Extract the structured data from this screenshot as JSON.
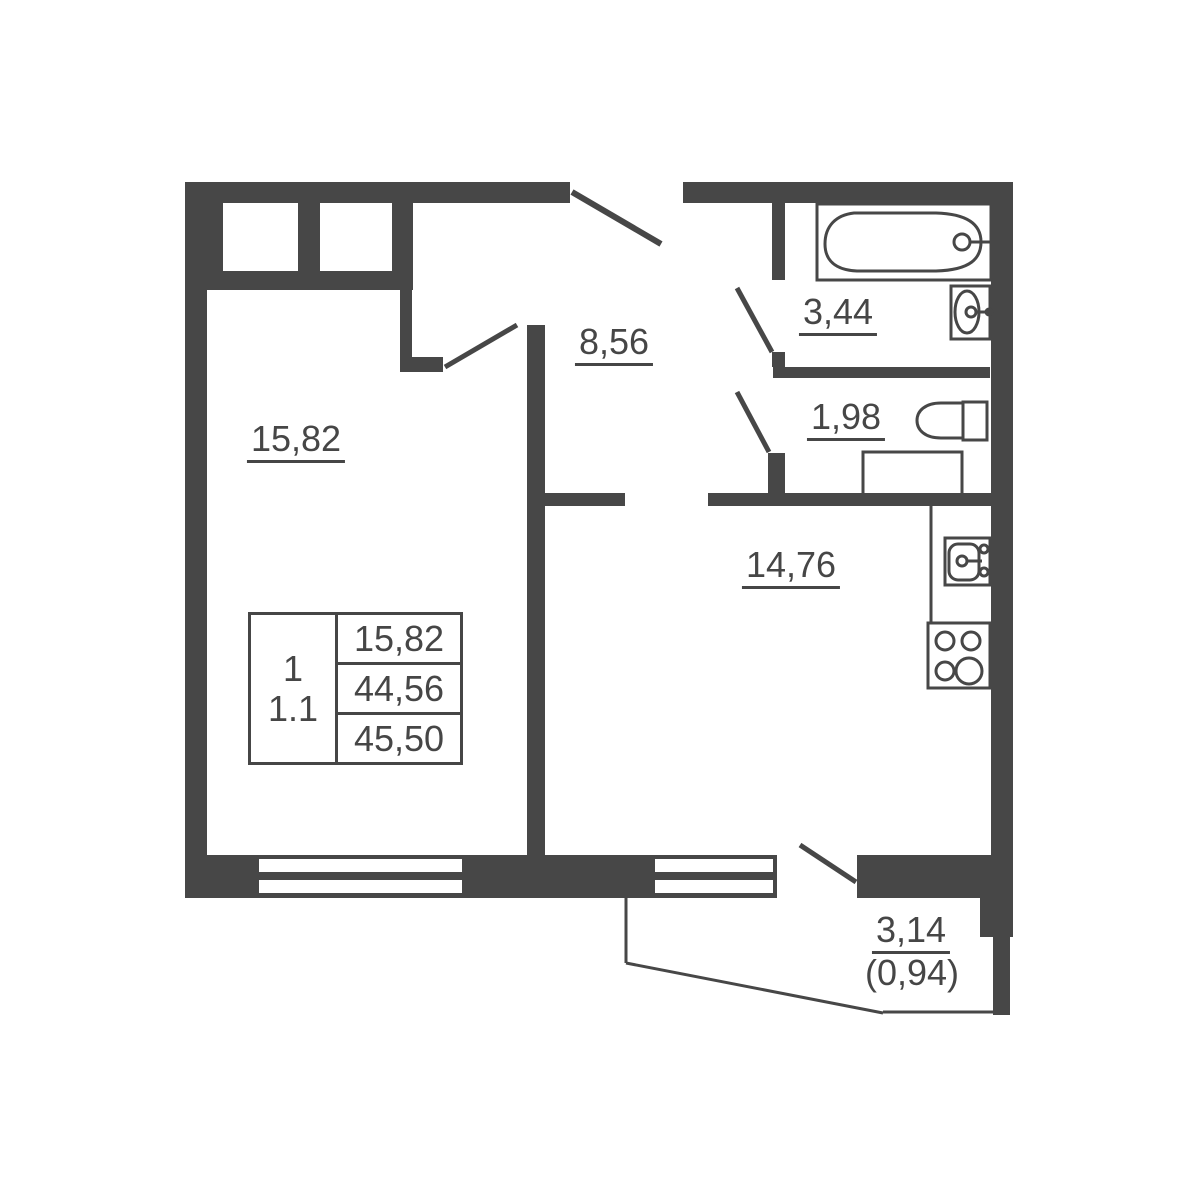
{
  "plan": {
    "title": "one-room apartment floor plan",
    "colors": {
      "wall": "#474747",
      "background": "#ffffff"
    },
    "rooms": [
      {
        "name": "living-room",
        "area": "15,82"
      },
      {
        "name": "hallway",
        "area": "8,56"
      },
      {
        "name": "bathroom",
        "area": "3,44"
      },
      {
        "name": "toilet",
        "area": "1,98"
      },
      {
        "name": "kitchen-living-room",
        "area": "14,76"
      },
      {
        "name": "balcony",
        "area": "3,14",
        "area_with_coefficient": "(0,94)"
      }
    ],
    "info_table": {
      "rooms_count": "1",
      "layout_code": "1.1",
      "rows": [
        "15,82",
        "44,56",
        "45,50"
      ]
    },
    "fixtures": [
      "bathtub",
      "washbasin",
      "toilet-bowl",
      "cabinet",
      "kitchen-sink",
      "stove"
    ]
  }
}
